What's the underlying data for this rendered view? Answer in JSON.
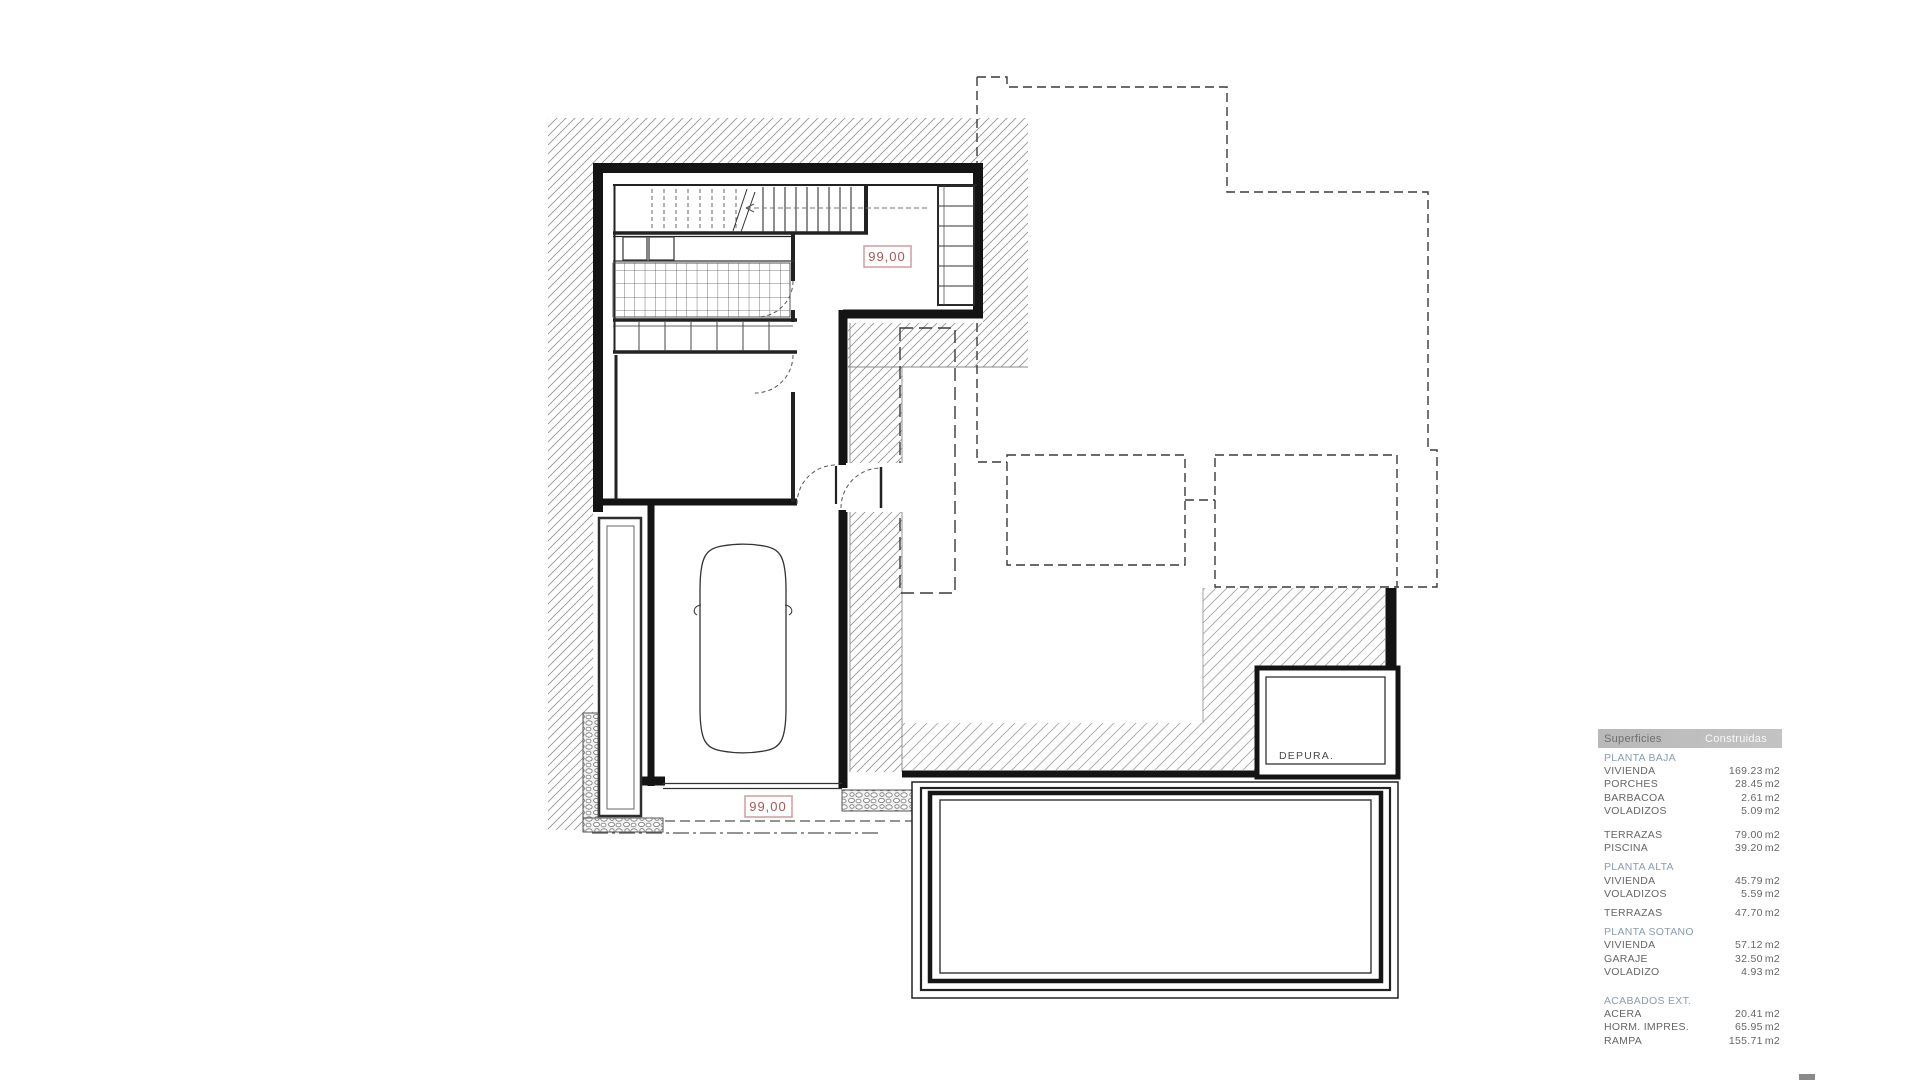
{
  "plan": {
    "labels": {
      "area_top": "99,00",
      "area_bottom": "99,00",
      "depura_room": "DEPURA."
    },
    "icons": [
      "car-icon",
      "stair-icon",
      "door-arc-icon",
      "pool-icon"
    ]
  },
  "colors": {
    "accent_red": "#a85757",
    "label_border": "#d4a3a3",
    "section_color": "#8a9cb2",
    "text_color": "#666666",
    "bar_bg": "#bdbdbd",
    "bar_text_left": "#6e6e6e",
    "bar_text_right": "#f7f7f7",
    "line_dark": "#141414"
  },
  "legend": {
    "header": {
      "col1": "Superficies",
      "col2": "Construidas"
    },
    "rows": [
      {
        "type": "section",
        "label": "PLANTA BAJA"
      },
      {
        "type": "item",
        "label": "VIVIENDA",
        "value": "169.23",
        "unit": "m2"
      },
      {
        "type": "item",
        "label": "PORCHES",
        "value": "28.45",
        "unit": "m2"
      },
      {
        "type": "item",
        "label": "BARBACOA",
        "value": "2.61",
        "unit": "m2"
      },
      {
        "type": "item",
        "label": "VOLADIZOS",
        "value": "5.09",
        "unit": "m2"
      },
      {
        "type": "spacer",
        "size": "lg"
      },
      {
        "type": "item",
        "label": "TERRAZAS",
        "value": "79.00",
        "unit": "m2"
      },
      {
        "type": "item",
        "label": "PISCINA",
        "value": "39.20",
        "unit": "m2"
      },
      {
        "type": "spacer",
        "size": "sm"
      },
      {
        "type": "section",
        "label": "PLANTA ALTA"
      },
      {
        "type": "item",
        "label": "VIVIENDA",
        "value": "45.79",
        "unit": "m2"
      },
      {
        "type": "item",
        "label": "VOLADIZOS",
        "value": "5.59",
        "unit": "m2"
      },
      {
        "type": "spacer",
        "size": "sm"
      },
      {
        "type": "item",
        "label": "TERRAZAS",
        "value": "47.70",
        "unit": "m2"
      },
      {
        "type": "spacer",
        "size": "sm"
      },
      {
        "type": "section",
        "label": "PLANTA SOTANO"
      },
      {
        "type": "item",
        "label": "VIVIENDA",
        "value": "57.12",
        "unit": "m2"
      },
      {
        "type": "item",
        "label": "GARAJE",
        "value": "32.50",
        "unit": "m2"
      },
      {
        "type": "item",
        "label": "VOLADIZO",
        "value": "4.93",
        "unit": "m2"
      },
      {
        "type": "spacer",
        "size": "xl"
      },
      {
        "type": "section",
        "label": "ACABADOS EXT."
      },
      {
        "type": "item",
        "label": "ACERA",
        "value": "20.41",
        "unit": "m2"
      },
      {
        "type": "item",
        "label": "HORM. IMPRES.",
        "value": "65.95",
        "unit": "m2"
      },
      {
        "type": "item",
        "label": "RAMPA",
        "value": "155.71",
        "unit": "m2"
      }
    ]
  }
}
